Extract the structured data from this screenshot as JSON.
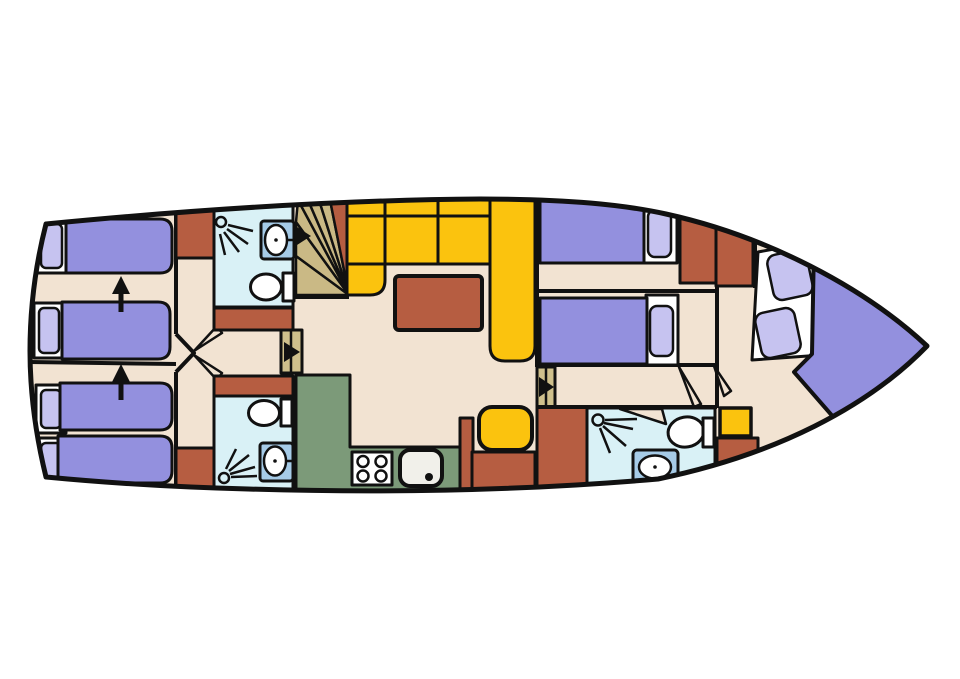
{
  "diagram": {
    "kind": "yacht-deck-floorplan",
    "canvas": {
      "w": 960,
      "h": 679
    },
    "palette": {
      "floor": "#f2e3d2",
      "bath": "#d9f1f6",
      "sink": "#a6cbe7",
      "bed": "#9390de",
      "pillow": "#c6c3f0",
      "sofa": "#fbc30e",
      "wood": "#b65d41",
      "galley": "#7c9a79",
      "stair": "#cab985",
      "door": "#cfc08c",
      "white": "#ffffff",
      "cream": "#f1f0ea",
      "line": "#111111"
    },
    "hull": {
      "path": "M46,224 C180,211 330,200 480,199 C570,199 625,205 666,214 C766,236 864,287 927,346 C868,407 775,455 658,479 C520,491 380,493 248,489 C170,487 98,482 46,477 C35,432 30,392 30,351 C30,309 35,267 46,224 Z",
      "stroke_width": 5
    },
    "elements": [
      {
        "n": "wall-left-cabin-divider",
        "k": "line",
        "x1": 30,
        "y1": 362,
        "x2": 176,
        "y2": 364,
        "sw": 4
      },
      {
        "n": "bed-frame",
        "k": "rect",
        "x": 36,
        "y": 219,
        "w": 32,
        "h": 54,
        "f": "white"
      },
      {
        "n": "bed-pillow",
        "k": "rect",
        "x": 41,
        "y": 224,
        "w": 21,
        "h": 44,
        "rx": 5,
        "f": "pillow",
        "sw": 2.5
      },
      {
        "n": "bed-mattress",
        "k": "path",
        "d": "M66,219 H160 Q172,219 172,231 V261 Q172,273 160,273 H66 Z",
        "f": "bed"
      },
      {
        "n": "bed-frame",
        "k": "rect",
        "x": 34,
        "y": 303,
        "w": 30,
        "h": 55,
        "f": "white"
      },
      {
        "n": "bed-pillow",
        "k": "rect",
        "x": 39,
        "y": 308,
        "w": 20,
        "h": 45,
        "rx": 5,
        "f": "pillow",
        "sw": 2.5
      },
      {
        "n": "bed-mattress",
        "k": "path",
        "d": "M62,302 H158 Q170,302 170,314 V347 Q170,359 158,359 H62 Z",
        "f": "bed"
      },
      {
        "n": "bed-frame",
        "k": "rect",
        "x": 36,
        "y": 385,
        "w": 30,
        "h": 48,
        "f": "white"
      },
      {
        "n": "bed-pillow",
        "k": "rect",
        "x": 41,
        "y": 390,
        "w": 20,
        "h": 38,
        "rx": 5,
        "f": "pillow",
        "sw": 2.5
      },
      {
        "n": "bed-mattress",
        "k": "path",
        "d": "M60,383 H160 Q172,383 172,395 V418 Q172,430 160,430 H60 Z",
        "f": "bed"
      },
      {
        "n": "bed-frame",
        "k": "rect",
        "x": 36,
        "y": 438,
        "w": 30,
        "h": 47,
        "f": "white"
      },
      {
        "n": "bed-pillow",
        "k": "rect",
        "x": 41,
        "y": 443,
        "w": 20,
        "h": 37,
        "rx": 5,
        "f": "pillow",
        "sw": 2.5
      },
      {
        "n": "bed-mattress",
        "k": "path",
        "d": "M58,436 H160 Q172,436 172,448 V471 Q172,483 160,483 H58 Z",
        "f": "bed"
      },
      {
        "n": "direction-arrow-icon",
        "k": "line",
        "x1": 121,
        "y1": 312,
        "x2": 121,
        "y2": 292,
        "sw": 5
      },
      {
        "n": "direction-arrow-head-icon",
        "k": "polygon",
        "p": "112,294 130,294 121,276",
        "f": "line",
        "s": "none"
      },
      {
        "n": "direction-arrow-icon",
        "k": "line",
        "x1": 121,
        "y1": 400,
        "x2": 121,
        "y2": 380,
        "sw": 5
      },
      {
        "n": "direction-arrow-head-icon",
        "k": "polygon",
        "p": "112,382 130,382 121,364",
        "f": "line",
        "s": "none"
      },
      {
        "n": "wall-corridor-left-upper",
        "k": "line",
        "x1": 176,
        "y1": 204,
        "x2": 176,
        "y2": 334,
        "sw": 4
      },
      {
        "n": "wall-corridor-left-lower",
        "k": "line",
        "x1": 176,
        "y1": 372,
        "x2": 176,
        "y2": 486,
        "sw": 4
      },
      {
        "n": "wall-cabin-doors",
        "k": "polyline",
        "p": "176,334 194,353 176,372",
        "sw": 4
      },
      {
        "n": "cabin-door-leaf",
        "k": "polygon",
        "p": "194,351 222,333 217,326",
        "f": "floor",
        "sw": 2.5
      },
      {
        "n": "cabin-door-leaf",
        "k": "polygon",
        "p": "194,355 222,373 217,380",
        "f": "floor",
        "sw": 2.5
      },
      {
        "n": "wardrobe-cabinet",
        "k": "rect",
        "x": 176,
        "y": 206,
        "w": 38,
        "h": 52,
        "f": "wood"
      },
      {
        "n": "wardrobe-cabinet",
        "k": "rect",
        "x": 176,
        "y": 448,
        "w": 38,
        "h": 40,
        "f": "wood"
      },
      {
        "n": "bathroom-room",
        "k": "rect",
        "x": 214,
        "y": 204,
        "w": 79,
        "h": 103,
        "f": "bath"
      },
      {
        "n": "shower-head-icon",
        "k": "circle",
        "cx": 221,
        "cy": 222,
        "r": 5,
        "f": "bath",
        "sw": 2.5
      },
      {
        "n": "shower-spray-icon",
        "k": "path",
        "d": "M228,225 L253,231 M227,229 L248,244 M224,232 L239,252 M220,234 L225,255",
        "sw": 2.5
      },
      {
        "n": "sink-counter",
        "k": "rect",
        "x": 261,
        "y": 221,
        "w": 33,
        "h": 38,
        "rx": 3,
        "f": "sink"
      },
      {
        "n": "sink-bowl",
        "k": "ellipse",
        "cx": 276,
        "cy": 240,
        "rx": 11,
        "ry": 15,
        "f": "white",
        "sw": 2.5
      },
      {
        "n": "sink-faucet-icon",
        "k": "line",
        "x1": 287,
        "y1": 240,
        "x2": 297,
        "y2": 240,
        "sw": 2.5
      },
      {
        "n": "sink-drain-icon",
        "k": "circle",
        "cx": 276,
        "cy": 240,
        "r": 1.8,
        "f": "line",
        "s": "none"
      },
      {
        "n": "toilet-bowl",
        "k": "ellipse",
        "cx": 266,
        "cy": 287,
        "rx": 15.5,
        "ry": 13,
        "f": "white"
      },
      {
        "n": "toilet-tank",
        "k": "rect",
        "x": 283,
        "y": 273,
        "w": 11,
        "h": 28,
        "f": "white"
      },
      {
        "n": "wardrobe-cabinet",
        "k": "rect",
        "x": 214,
        "y": 308,
        "w": 79,
        "h": 22,
        "f": "wood"
      },
      {
        "n": "door-corridor-to-salon",
        "k": "rect",
        "x": 281,
        "y": 330,
        "w": 21,
        "h": 43,
        "f": "door"
      },
      {
        "n": "door-leaf-split",
        "k": "line",
        "x1": 291,
        "y1": 330,
        "x2": 291,
        "y2": 373,
        "sw": 2.5
      },
      {
        "n": "door-arrow-icon",
        "k": "polygon",
        "p": "284,342 284,362 300,352",
        "f": "line",
        "s": "none"
      },
      {
        "n": "wardrobe-cabinet",
        "k": "rect",
        "x": 214,
        "y": 376,
        "w": 79,
        "h": 20,
        "f": "wood"
      },
      {
        "n": "bathroom-room",
        "k": "rect",
        "x": 214,
        "y": 396,
        "w": 79,
        "h": 98,
        "f": "bath"
      },
      {
        "n": "toilet-bowl",
        "k": "ellipse",
        "cx": 264,
        "cy": 413,
        "rx": 15.5,
        "ry": 12.5,
        "f": "white"
      },
      {
        "n": "toilet-tank",
        "k": "rect",
        "x": 281,
        "y": 399,
        "w": 11,
        "h": 27,
        "f": "white"
      },
      {
        "n": "sink-counter",
        "k": "rect",
        "x": 260,
        "y": 443,
        "w": 33,
        "h": 38,
        "rx": 3,
        "f": "sink"
      },
      {
        "n": "sink-bowl",
        "k": "ellipse",
        "cx": 275,
        "cy": 461,
        "rx": 11,
        "ry": 14.5,
        "f": "white",
        "sw": 2.5
      },
      {
        "n": "sink-faucet-icon",
        "k": "line",
        "x1": 286,
        "y1": 461,
        "x2": 296,
        "y2": 461,
        "sw": 2.5
      },
      {
        "n": "sink-drain-icon",
        "k": "circle",
        "cx": 275,
        "cy": 461,
        "r": 1.8,
        "f": "line",
        "s": "none"
      },
      {
        "n": "shower-head-icon",
        "k": "circle",
        "cx": 224,
        "cy": 478,
        "r": 5,
        "f": "bath",
        "sw": 2.5
      },
      {
        "n": "shower-spray-icon",
        "k": "path",
        "d": "M230,474 L255,467 M229,471 L249,455 M226,469 L236,449 M231,477 L257,476",
        "sw": 2.5
      },
      {
        "n": "stair-step",
        "k": "polygon",
        "p": "349,295 296,295 296,256",
        "f": "stair",
        "sw": 2.5
      },
      {
        "n": "stair-step",
        "k": "polygon",
        "p": "349,295 296,256 296,222",
        "f": "stair",
        "sw": 2.5
      },
      {
        "n": "stair-step",
        "k": "polygon",
        "p": "349,295 296,222 298,200",
        "f": "stair",
        "sw": 2.5
      },
      {
        "n": "stair-step",
        "k": "polygon",
        "p": "349,295 298,200 308,200",
        "f": "stair",
        "sw": 2.5
      },
      {
        "n": "stair-step",
        "k": "polygon",
        "p": "349,295 308,200 319,200",
        "f": "stair",
        "sw": 2.5
      },
      {
        "n": "stair-step",
        "k": "polygon",
        "p": "349,295 319,200 330,200",
        "f": "stair",
        "sw": 2.5
      },
      {
        "n": "stair-landing",
        "k": "polygon",
        "p": "349,295 330,200 349,200",
        "f": "wood",
        "sw": 2.5
      },
      {
        "n": "wall-under-stairs",
        "k": "line",
        "x1": 294,
        "y1": 297,
        "x2": 349,
        "y2": 297,
        "sw": 4
      },
      {
        "n": "door-arrow-icon",
        "k": "polygon",
        "p": "297,227 297,245 311,236",
        "f": "line",
        "s": "none"
      },
      {
        "n": "wall-salon-right",
        "k": "line",
        "x1": 537,
        "y1": 200,
        "x2": 537,
        "y2": 367,
        "sw": 4
      },
      {
        "n": "sofa-backrest",
        "k": "rect",
        "x": 347,
        "y": 198,
        "w": 143,
        "h": 18,
        "f": "sofa"
      },
      {
        "n": "sofa-backrest-divider",
        "k": "path",
        "d": "M385,200 V216 M438,200 V216",
        "sw": 3
      },
      {
        "n": "sofa-seat",
        "k": "rect",
        "x": 347,
        "y": 216,
        "w": 38,
        "h": 48,
        "f": "sofa"
      },
      {
        "n": "sofa-seat",
        "k": "rect",
        "x": 385,
        "y": 216,
        "w": 53,
        "h": 48,
        "f": "sofa"
      },
      {
        "n": "sofa-seat",
        "k": "rect",
        "x": 438,
        "y": 216,
        "w": 52,
        "h": 48,
        "f": "sofa"
      },
      {
        "n": "sofa-corner-seat",
        "k": "path",
        "d": "M347,264 H385 V280 Q385,295 370,295 H347 Z",
        "f": "sofa"
      },
      {
        "n": "sofa-side-seat",
        "k": "path",
        "d": "M490,196 H535 V346 Q535,361 520,361 H505 Q490,361 490,346 Z",
        "f": "sofa"
      },
      {
        "n": "salon-table",
        "k": "rect",
        "x": 395,
        "y": 276,
        "w": 87,
        "h": 54,
        "rx": 4,
        "f": "wood",
        "sw": 4
      },
      {
        "n": "salon-stool",
        "k": "rect",
        "x": 479,
        "y": 407,
        "w": 53,
        "h": 43,
        "rx": 13,
        "f": "sofa",
        "sw": 4
      },
      {
        "n": "galley-counter",
        "k": "path",
        "d": "M296,375 H350 V447 H460 V494 H296 Z",
        "f": "galley"
      },
      {
        "n": "stove",
        "k": "rect",
        "x": 352,
        "y": 452,
        "w": 40,
        "h": 33,
        "f": "white"
      },
      {
        "n": "stove-burner-icon",
        "k": "circle",
        "cx": 363,
        "cy": 461.5,
        "r": 5.5,
        "f": "white",
        "sw": 2.5
      },
      {
        "n": "stove-burner-icon",
        "k": "circle",
        "cx": 381,
        "cy": 461.5,
        "r": 5.5,
        "f": "white",
        "sw": 2.5
      },
      {
        "n": "stove-burner-icon",
        "k": "circle",
        "cx": 363,
        "cy": 476,
        "r": 5.5,
        "f": "white",
        "sw": 2.5
      },
      {
        "n": "stove-burner-icon",
        "k": "circle",
        "cx": 381,
        "cy": 476,
        "r": 5.5,
        "f": "white",
        "sw": 2.5
      },
      {
        "n": "galley-sink",
        "k": "rect",
        "x": 400,
        "y": 450,
        "w": 42,
        "h": 36,
        "rx": 10,
        "f": "cream",
        "sw": 4
      },
      {
        "n": "galley-sink-drain-icon",
        "k": "circle",
        "cx": 429,
        "cy": 477,
        "r": 4,
        "f": "line",
        "s": "none"
      },
      {
        "n": "galley-divider",
        "k": "rect",
        "x": 460,
        "y": 418,
        "w": 13,
        "h": 76,
        "f": "wood"
      },
      {
        "n": "galley-counter-low",
        "k": "rect",
        "x": 472,
        "y": 452,
        "w": 63,
        "h": 42,
        "f": "wood"
      },
      {
        "n": "door-salon-to-aft",
        "k": "rect",
        "x": 537,
        "y": 367,
        "w": 18,
        "h": 41,
        "f": "door"
      },
      {
        "n": "door-leaf-split",
        "k": "line",
        "x1": 546,
        "y1": 367,
        "x2": 546,
        "y2": 408,
        "sw": 2.5
      },
      {
        "n": "door-arrow-icon",
        "k": "polygon",
        "p": "539,377 539,397 554,387",
        "f": "line",
        "s": "none"
      },
      {
        "n": "wardrobe-cabinet",
        "k": "rect",
        "x": 537,
        "y": 407,
        "w": 50,
        "h": 85,
        "f": "wood"
      },
      {
        "n": "wall-right-cabin-divider",
        "k": "line",
        "x1": 537,
        "y1": 291,
        "x2": 717,
        "y2": 291,
        "sw": 4
      },
      {
        "n": "wall-right-cabin-lower",
        "k": "line",
        "x1": 537,
        "y1": 365,
        "x2": 717,
        "y2": 365,
        "sw": 4
      },
      {
        "n": "wall-bow-separator",
        "k": "line",
        "x1": 717,
        "y1": 285,
        "x2": 717,
        "y2": 408,
        "sw": 4
      },
      {
        "n": "bed-frame",
        "k": "rect",
        "x": 643,
        "y": 203,
        "w": 34,
        "h": 60,
        "f": "white"
      },
      {
        "n": "bed-mattress",
        "k": "rect",
        "x": 540,
        "y": 200,
        "w": 104,
        "h": 63,
        "f": "bed"
      },
      {
        "n": "bed-pillow",
        "k": "rect",
        "x": 648,
        "y": 210,
        "w": 23,
        "h": 47,
        "rx": 7,
        "f": "pillow",
        "sw": 2.5
      },
      {
        "n": "wardrobe-cabinet",
        "k": "polygon",
        "p": "680,212 716,218 716,283 680,283",
        "f": "wood"
      },
      {
        "n": "wardrobe-cabinet",
        "k": "polygon",
        "p": "716,218 753,230 753,286 716,286",
        "f": "wood"
      },
      {
        "n": "bed-frame",
        "k": "rect",
        "x": 646,
        "y": 295,
        "w": 32,
        "h": 70,
        "f": "white"
      },
      {
        "n": "bed-mattress",
        "k": "rect",
        "x": 540,
        "y": 298,
        "w": 107,
        "h": 66,
        "f": "bed"
      },
      {
        "n": "bed-pillow",
        "k": "rect",
        "x": 650,
        "y": 306,
        "w": 23,
        "h": 50,
        "rx": 7,
        "f": "pillow",
        "sw": 2.5
      },
      {
        "n": "bow-door-leaf",
        "k": "polygon",
        "p": "679,367 701,404 694,407",
        "f": "floor",
        "sw": 2.5
      },
      {
        "n": "bow-door-leaf",
        "k": "polygon",
        "p": "714,366 731,391 724,396",
        "f": "floor",
        "sw": 2.5
      },
      {
        "n": "wall-bow-entry",
        "k": "line",
        "x1": 755,
        "y1": 238,
        "x2": 755,
        "y2": 288,
        "sw": 4
      },
      {
        "n": "wall-bathroom-top",
        "k": "line",
        "x1": 537,
        "y1": 407,
        "x2": 717,
        "y2": 407,
        "sw": 4
      },
      {
        "n": "bathroom-room",
        "k": "rect",
        "x": 587,
        "y": 408,
        "w": 128,
        "h": 84,
        "f": "bath"
      },
      {
        "n": "bathroom-door-leaf",
        "k": "polygon",
        "p": "620,409 666,424 662,409",
        "f": "floor",
        "sw": 2.5
      },
      {
        "n": "shower-head-icon",
        "k": "circle",
        "cx": 598,
        "cy": 420,
        "r": 5.5,
        "f": "bath",
        "sw": 2.5
      },
      {
        "n": "shower-spray-icon",
        "k": "path",
        "d": "M604,423 L633,429 M603,426 L626,446 M600,428 L610,453 M605,420 L637,419",
        "sw": 2.5
      },
      {
        "n": "toilet-bowl",
        "k": "ellipse",
        "cx": 686,
        "cy": 432,
        "rx": 18,
        "ry": 15,
        "f": "white",
        "t": "rotate(-10 686 432)"
      },
      {
        "n": "toilet-tank",
        "k": "rect",
        "x": 703,
        "y": 418,
        "w": 11,
        "h": 29,
        "f": "white"
      },
      {
        "n": "sink-counter",
        "k": "rect",
        "x": 633,
        "y": 450,
        "w": 45,
        "h": 36,
        "rx": 4,
        "f": "sink"
      },
      {
        "n": "sink-bowl",
        "k": "ellipse",
        "cx": 655,
        "cy": 467,
        "rx": 16,
        "ry": 11.5,
        "f": "white",
        "sw": 2.5
      },
      {
        "n": "sink-faucet-icon",
        "k": "line",
        "x1": 655,
        "y1": 478,
        "x2": 655,
        "y2": 490,
        "sw": 2.5
      },
      {
        "n": "sink-drain-icon",
        "k": "circle",
        "cx": 655,
        "cy": 467,
        "r": 1.8,
        "f": "line",
        "s": "none"
      },
      {
        "n": "bow-stool",
        "k": "rect",
        "x": 720,
        "y": 408,
        "w": 31,
        "h": 28,
        "f": "sofa",
        "sw": 3.5
      },
      {
        "n": "wardrobe-cabinet",
        "k": "rect",
        "x": 717,
        "y": 438,
        "w": 41,
        "h": 42,
        "f": "wood"
      },
      {
        "n": "bed-frame",
        "k": "polygon",
        "p": "758,252 812,242 822,355 752,360",
        "f": "white"
      },
      {
        "n": "bed-pillow",
        "k": "rect",
        "x": 770,
        "y": 252,
        "w": 40,
        "h": 46,
        "rx": 9,
        "f": "pillow",
        "sw": 2.5,
        "t": "rotate(-12 790 275)"
      },
      {
        "n": "bed-pillow",
        "k": "rect",
        "x": 758,
        "y": 310,
        "w": 40,
        "h": 46,
        "rx": 9,
        "f": "pillow",
        "sw": 2.5,
        "t": "rotate(-12 778 333)"
      },
      {
        "n": "bed-mattress",
        "k": "path",
        "d": "M814,244 C856,254 902,300 932,350 C898,392 860,412 835,419 L794,372 L812,354 Z",
        "f": "bed",
        "sw": 4
      }
    ]
  }
}
